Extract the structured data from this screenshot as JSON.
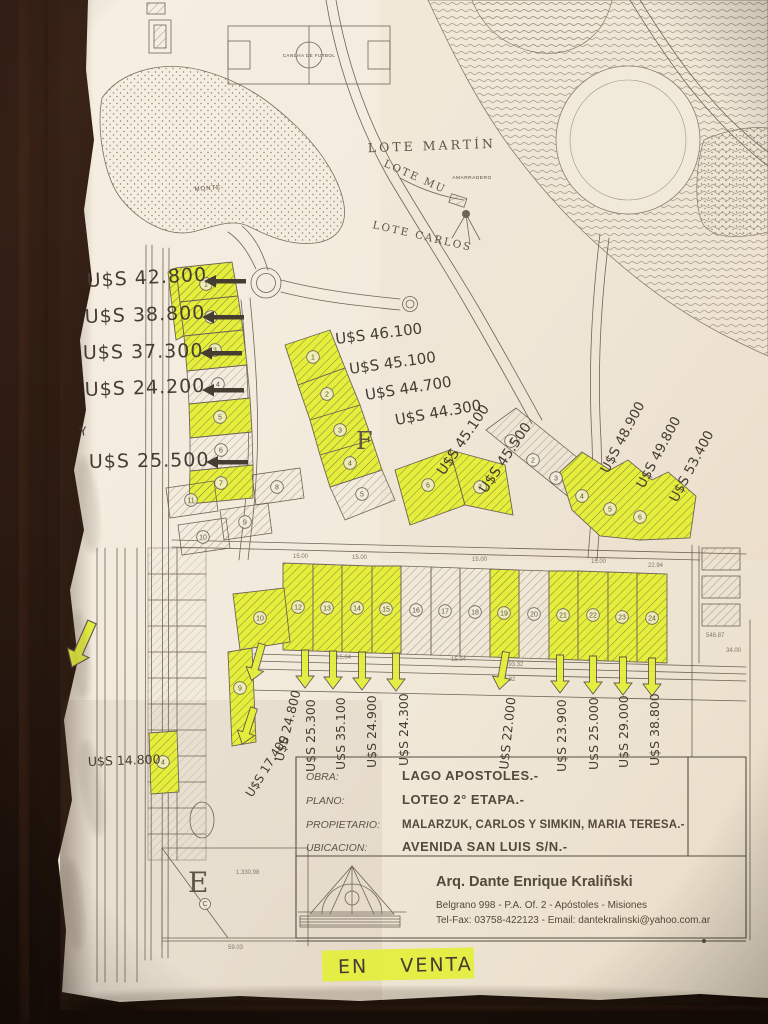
{
  "photo": {
    "wood": "#2b1a11",
    "paper": "#f2ebdd",
    "highlight": "#e4ee3b",
    "ink": "#6f6557",
    "hand_ink": "#453d31"
  },
  "map_labels": {
    "lote_martin": "LOTE MARTÍN",
    "lote_mu": "LOTE MU",
    "lote_carlos": "LOTE CARLOS",
    "amarradero": "AMARRADERO",
    "cancha": "CANCHA DE FUTBOL",
    "monte": "MONTE",
    "block_e": "E",
    "block_f": "F",
    "block_e_area": "1.330,98",
    "c_mark": "C",
    "y_mark": "Y"
  },
  "prices": {
    "left": [
      "U$S 42.800",
      "U$S 38.800",
      "U$S 37.300",
      "U$S 24.200",
      "U$S 25.500"
    ],
    "left_bottom": "U$S 14.800",
    "mid": [
      "U$S 46.100",
      "U$S 45.100",
      "U$S 44.700",
      "U$S 44.300"
    ],
    "mid_diag": [
      "U$S 45.100",
      "U$S 45.500"
    ],
    "right_diag": [
      "U$S 48.900",
      "U$S 49.800",
      "U$S 53.400"
    ],
    "bottom_left": [
      "U$S 24.800",
      "U$S 25.300",
      "U$S 35.100",
      "U$S 24.900",
      "U$S 24.300"
    ],
    "bottom_right": [
      "U$S 22.000",
      "U$S 23.900",
      "U$S 25.000",
      "U$S 29.000",
      "U$S 38.800"
    ],
    "diag_left": "U$S 17.400"
  },
  "lot_numbers": {
    "left_col": [
      "1",
      "2",
      "3",
      "4",
      "5",
      "6",
      "7"
    ],
    "left_cluster": [
      "8",
      "11",
      "9",
      "10"
    ],
    "mid_cluster": [
      "1",
      "2",
      "3",
      "4",
      "5",
      "6",
      "7"
    ],
    "right_cluster": [
      "1",
      "2",
      "3",
      "4",
      "5",
      "6"
    ],
    "bottom_row": [
      "12",
      "13",
      "14",
      "15",
      "16",
      "17",
      "18",
      "19",
      "20",
      "21",
      "22",
      "23",
      "24"
    ],
    "corner_lot": "10",
    "strip_lot": "9",
    "single_lot": "4"
  },
  "dims": {
    "d_29332": "293.32",
    "d_27632": "276.32",
    "d_5903": "59.03",
    "d_54887": "548.87",
    "d_3400": "34.00",
    "d_2294": "22.94",
    "lot_w": "15.00",
    "lot_w2": "15.04"
  },
  "title_block": {
    "rows": [
      {
        "label": "OBRA:",
        "value": "LAGO APOSTOLES.-"
      },
      {
        "label": "PLANO:",
        "value": "LOTEO 2° ETAPA.-"
      },
      {
        "label": "PROPIETARIO:",
        "value": "MALARZUK, CARLOS Y SIMKIN, MARIA TERESA.-"
      },
      {
        "label": "UBICACION:",
        "value": "AVENIDA SAN LUIS S/N.-"
      }
    ]
  },
  "architect": {
    "name": "Arq. Dante Enrique Kraliñski",
    "address": "Belgrano 998 - P.A. Of. 2 - Apóstoles - Misiones",
    "contact": "Tel-Fax: 03758-422123 - Email: dantekralinski@yahoo.com.ar"
  },
  "sale_tag": "EN    VENTA"
}
